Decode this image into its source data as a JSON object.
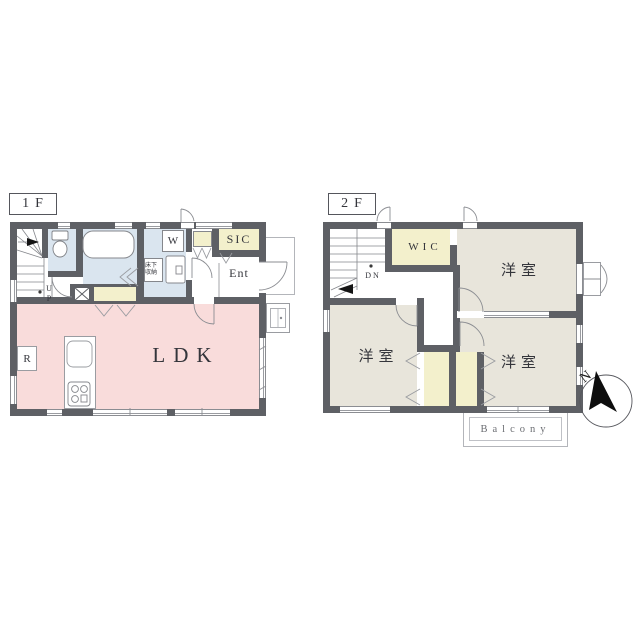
{
  "colors": {
    "wall": "#5e6065",
    "ldk": "#f9dcdb",
    "wet": "#dae5ef",
    "closet": "#f3f0cc",
    "bedroom": "#e8e5db"
  },
  "floor1": {
    "tag": "1F",
    "rooms": {
      "ldk": "LDK",
      "refrigerator": "R",
      "washer": "W",
      "underfloor_storage": "床下収納",
      "shoe_closet": "SIC",
      "entrance": "Ent",
      "stairs_up": "UP"
    }
  },
  "floor2": {
    "tag": "2F",
    "rooms": {
      "walk_in_closet": "WIC",
      "bedroom_ne": "洋室",
      "bedroom_sw": "洋室",
      "bedroom_se": "洋室",
      "stairs_down": "DN",
      "balcony": "Balcony"
    }
  },
  "compass": {
    "north": "N"
  }
}
